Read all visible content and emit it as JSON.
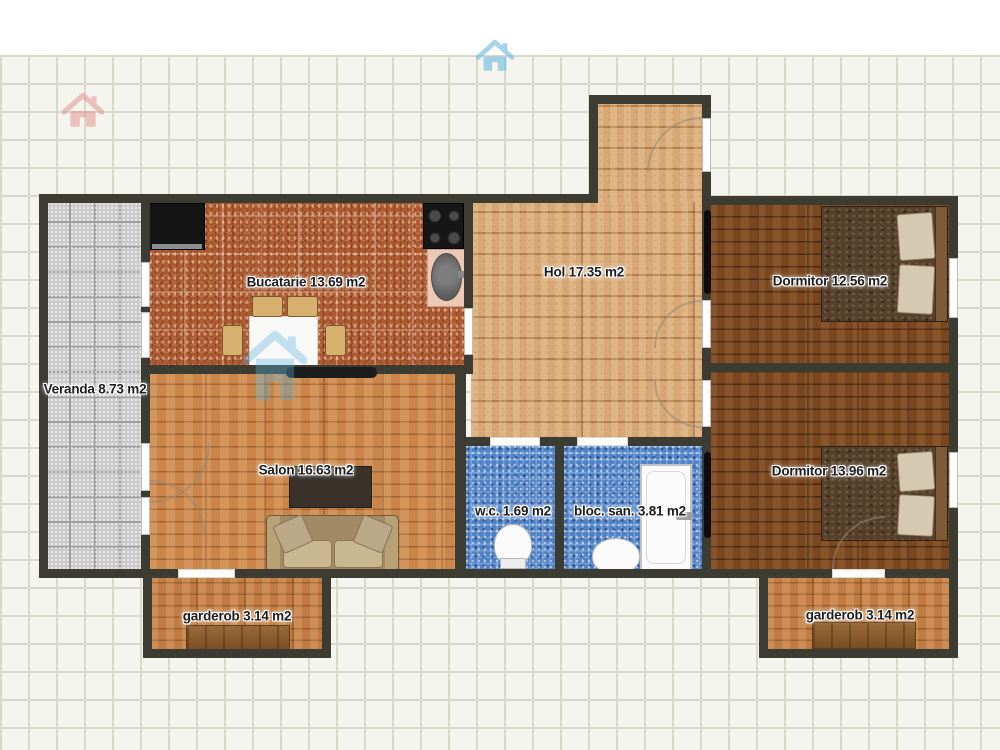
{
  "plan": {
    "rooms": [
      {
        "id": "veranda",
        "label": "Veranda 8.73 m2"
      },
      {
        "id": "bucatarie",
        "label": "Bucatarie 13.69 m2"
      },
      {
        "id": "hol",
        "label": "Hol 17.35 m2"
      },
      {
        "id": "dormitor_top",
        "label": "Dormitor 12.56 m2"
      },
      {
        "id": "dormitor_bottom",
        "label": "Dormitor 13.96 m2"
      },
      {
        "id": "salon",
        "label": "Salon 16.63 m2"
      },
      {
        "id": "wc",
        "label": "w.c. 1.69 m2"
      },
      {
        "id": "bloc_san",
        "label": "bloc. san. 3.81 m2"
      },
      {
        "id": "garderob_left",
        "label": "garderob 3.14 m2"
      },
      {
        "id": "garderob_right",
        "label": "garderob 3.14 m2"
      }
    ]
  },
  "icons": {
    "top_left": "home-icon-red",
    "top_center": "home-icon-blue",
    "center_watermark": "home-icon-watermark"
  },
  "colors": {
    "wall": "#3c3c33",
    "grid_line": "#d9d9cb",
    "canvas": "#f5f5ef",
    "kitchen_tile": "#ae5a31",
    "bath_tile": "#4f82c4",
    "hol_wood": "#d7a876",
    "salon_wood": "#c9854a",
    "bedroom_wood": "#7a4720",
    "veranda_tile": "#c9c9c9",
    "logo_red": "#e89a9a",
    "logo_blue": "#7ec3e8"
  }
}
